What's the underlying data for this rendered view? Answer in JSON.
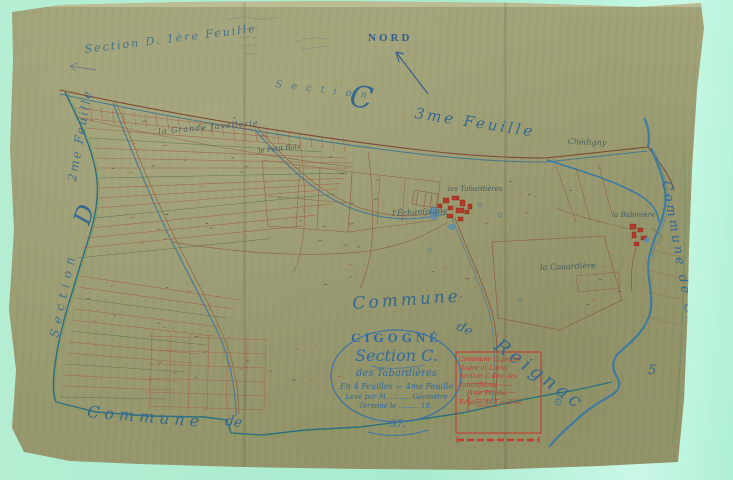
{
  "compass": {
    "label": "NORD"
  },
  "sheet_labels": {
    "top_left": "Section D. 1ère Feuille",
    "top_section_word": "Section",
    "top_letter": "C",
    "top_sheet": "3me Feuille",
    "west_section_word": "Section",
    "west_letter": "D",
    "west_sheet": "2me Feuille",
    "sheet_digit": "5",
    "page_number": "37."
  },
  "communes": {
    "bottom_word": "Commune",
    "bottom_de": "de",
    "center_word": "Commune",
    "center_de": "de",
    "center_name": "Reignac",
    "east_label": "Commune de Chédigny"
  },
  "roads": {
    "north_label": "Chédigny"
  },
  "places": {
    "grande_javellerie": "la Grande Javellerie",
    "petit_bois": "le Petit Bois",
    "echampigny": "l'Échampigny",
    "tabardieres": "les Tabardières",
    "couardiere": "la Couardière",
    "babiniere": "la Babinière"
  },
  "cartouche": {
    "title": "CIGOGNÉ",
    "section": "Section C.",
    "subtitle": "des Tabardières",
    "sheets_line": "En 4 Feuilles — 4me Feuille",
    "surveyor_line": "Levé par M. ......... Géomètre",
    "date_line": "Terminé le ......... 18.."
  },
  "legend_box": {
    "line1": "Commune Cigogné (Indre et Loire)",
    "line2": "Section C dite des Tabardières",
    "line3": "4me Feuille",
    "line4": "Échelle de 1 à 2500"
  },
  "colors": {
    "paper": "#9d9d73",
    "scan_background": "#aeeccf",
    "ink_blue": "#34688f",
    "ink_red": "#c23b2f",
    "parcel_brown": "#a65340",
    "river_blue": "#3a7ba2"
  }
}
